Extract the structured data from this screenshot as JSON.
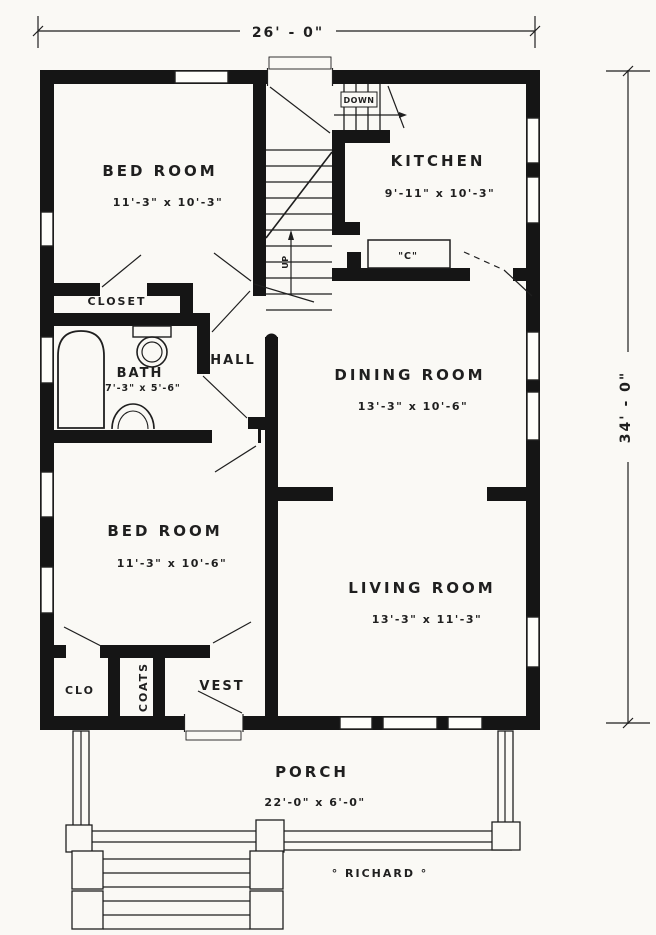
{
  "colors": {
    "paper": "#faf9f5",
    "ink": "#1f1f1f",
    "wall": "#151515"
  },
  "plan_title": "° RICHARD °",
  "dimensions": {
    "top": "26' - 0\"",
    "right": "34' - 0\""
  },
  "rooms": {
    "bedroom_top": {
      "name": "BED ROOM",
      "size": "11'-3\" x 10'-3\""
    },
    "kitchen": {
      "name": "KITCHEN",
      "size": "9'-11\" x 10'-3\""
    },
    "closet": {
      "name": "CLOSET"
    },
    "bath": {
      "name": "BATH",
      "size": "7'-3\" x 5'-6\""
    },
    "hall": {
      "name": "HALL"
    },
    "dining": {
      "name": "DINING ROOM",
      "size": "13'-3\" x 10'-6\""
    },
    "bedroom_bottom": {
      "name": "BED ROOM",
      "size": "11'-3\" x 10'-6\""
    },
    "living": {
      "name": "LIVING ROOM",
      "size": "13'-3\" x 11'-3\""
    },
    "clo": {
      "name": "CLO"
    },
    "coats": {
      "name": "COATS"
    },
    "vest": {
      "name": "VEST"
    },
    "porch": {
      "name": "PORCH",
      "size": "22'-0\" x 6'-0\""
    }
  },
  "stairs": {
    "down_label": "DOWN",
    "up_label": "UP"
  },
  "kitchen_counter_label": "\"C\""
}
